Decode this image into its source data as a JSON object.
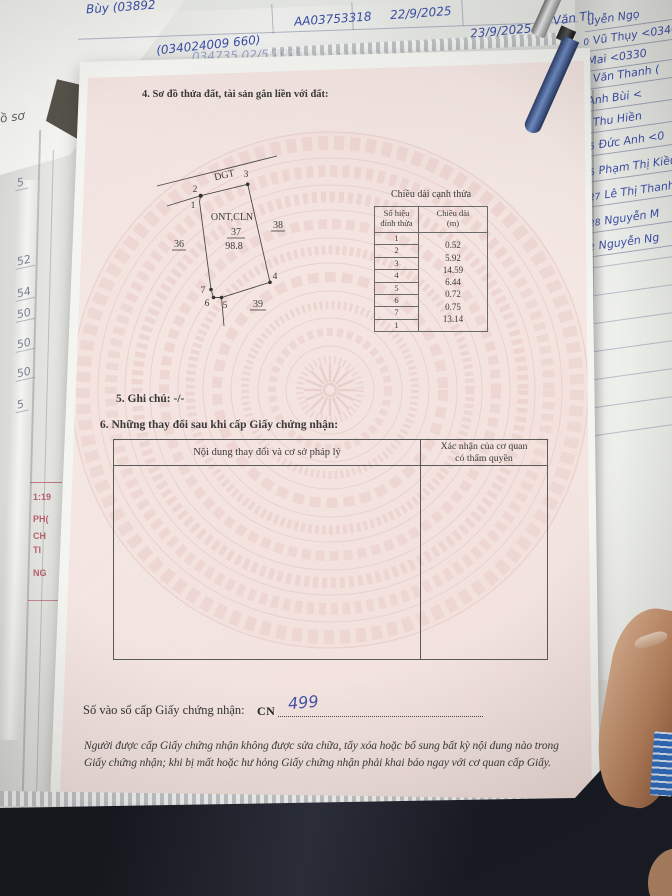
{
  "colors": {
    "paper_pink": "#f3e5e1",
    "pattern_pink": "#ecd2cd",
    "ink_blue": "#3b4ea8",
    "stamp_red": "#b0485a"
  },
  "document": {
    "section4_title": "4. Sơ đồ thửa đất, tài sản gắn liền với đất:",
    "diagram": {
      "road_label": "DGT",
      "land_use_label": "ONT,CLN",
      "parcel_number": "37",
      "parcel_area": "98.8",
      "adjacent_left": "36",
      "adjacent_right": "38",
      "adjacent_bottom": "39",
      "vertex_labels": [
        "1",
        "2",
        "3",
        "4",
        "5",
        "6",
        "7"
      ]
    },
    "edge_table": {
      "title": "Chiều dài cạnh thửa",
      "col1_header_line1": "Số hiệu",
      "col1_header_line2": "đỉnh thửa",
      "col2_header_line1": "Chiều dài",
      "col2_header_line2": "(m)",
      "vertices": [
        "1",
        "2",
        "3",
        "4",
        "5",
        "6",
        "7",
        "1"
      ],
      "lengths": [
        "0.52",
        "5.92",
        "14.59",
        "6.44",
        "0.72",
        "0.75",
        "13.14"
      ]
    },
    "section5_title": "5. Ghi chú: -/-",
    "section6_title": "6. Những thay đổi sau khi cấp Giấy chứng nhận:",
    "changes_table": {
      "col1_header": "Nội dung thay đổi và cơ sở pháp lý",
      "col2_header_line1": "Xác nhận của cơ quan",
      "col2_header_line2": "có thẩm quyền"
    },
    "registry_label": "Số vào sổ cấp Giấy chứng nhận:",
    "registry_prefix": "CN",
    "registry_number": "499",
    "footer_line1": "Người được cấp Giấy chứng nhận không được sửa chữa, tẩy xóa hoặc bổ sung bất kỳ nội dung nào trong",
    "footer_line2": "Giấy chứng nhận; khi bị mất hoặc hư hỏng Giấy chứng nhận phải khai báo ngay với cơ quan cấp Giấy."
  },
  "background": {
    "top_notes": [
      "Bùy (03892",
      "(034024009 660)",
      "AA03753318",
      "22/9/2025",
      "23/9/2025",
      "ủi Văn Th",
      "034735  02/5/2025"
    ],
    "right_ledger_rows": [
      {
        "no": "",
        "name": "uyễn Ngọ"
      },
      {
        "no": "0",
        "name": "Vũ Thụy <03408"
      },
      {
        "no": "",
        "name": "Mai <0330"
      },
      {
        "no": "1",
        "name": "Văn Thanh ("
      },
      {
        "no": "",
        "name": "Anh Bùi <"
      },
      {
        "no": "5",
        "name": "Thu Hiền"
      },
      {
        "no": "15",
        "name": "Đức Anh <0"
      },
      {
        "no": "16",
        "name": "Phạm Thị Kiều"
      },
      {
        "no": "527",
        "name": "Lê Thị Thanh"
      },
      {
        "no": "528",
        "name": "Nguyễn M"
      },
      {
        "no": "52",
        "name": "Nguyễn Ng"
      }
    ],
    "left_margin_numbers": [
      "5",
      "52",
      "54",
      "50",
      "50",
      "50",
      "5"
    ],
    "left_label": "ồ sơ",
    "red_fragments": [
      "1:19",
      "PH(",
      "CH",
      "TI",
      "NG"
    ]
  }
}
